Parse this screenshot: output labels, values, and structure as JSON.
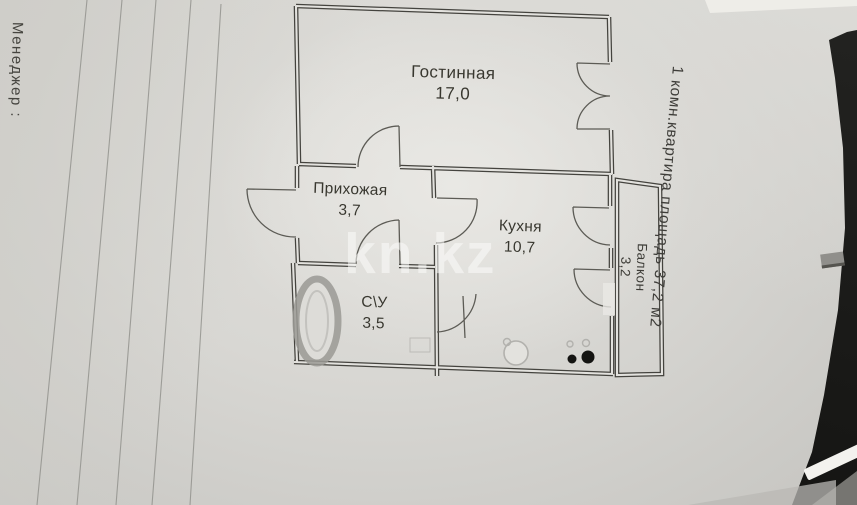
{
  "side_notes": {
    "left": "Менеджер :",
    "right": "1 комн.квартира площадь 37,2 м2"
  },
  "watermark": "kn.kz",
  "plan": {
    "rooms": [
      {
        "name": "Гостинная",
        "area": "17,0"
      },
      {
        "name": "Прихожая",
        "area": "3,7"
      },
      {
        "name": "Кухня",
        "area": "10,7"
      },
      {
        "name": "С\\У",
        "area": "3,5"
      },
      {
        "name": "Балкон",
        "area": "3,2"
      }
    ]
  },
  "colors": {
    "paper": "#d8d7d3",
    "wall": "#44433e",
    "background_dark": "#171715",
    "watermark": "rgba(252,252,250,0.55)"
  }
}
